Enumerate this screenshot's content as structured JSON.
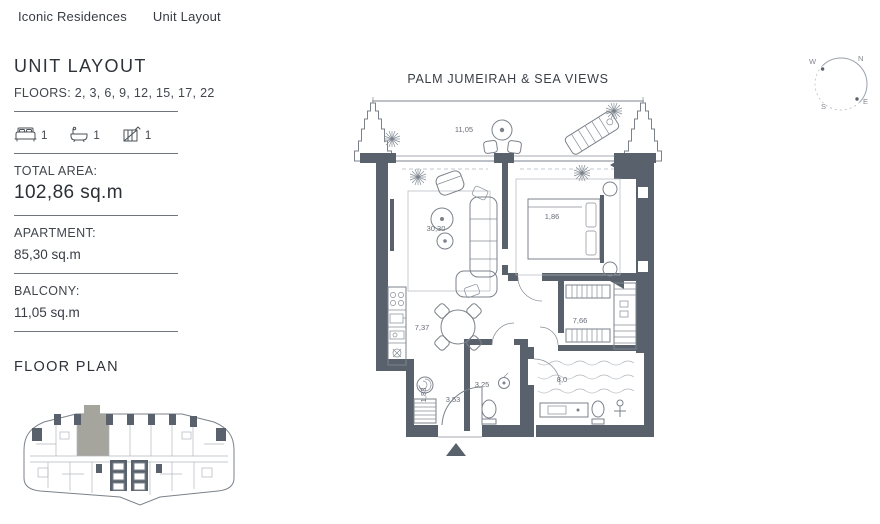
{
  "nav": {
    "brand": "Iconic Residences",
    "page": "Unit Layout"
  },
  "sidebar": {
    "title": "UNIT LAYOUT",
    "floors": "FLOORS: 2, 3, 6, 9, 12, 15, 17, 22",
    "features": [
      {
        "name": "bedrooms",
        "count": "1"
      },
      {
        "name": "bathrooms",
        "count": "1"
      },
      {
        "name": "balconies",
        "count": "1"
      }
    ],
    "stats": [
      {
        "label": "TOTAL AREA:",
        "value": "102,86 sq.m"
      },
      {
        "label": "APARTMENT:",
        "value": "85,30 sq.m"
      },
      {
        "label": "BALCONY:",
        "value": "11,05 sq.m"
      }
    ],
    "floor_plan_title": "FLOOR PLAN"
  },
  "plan": {
    "view_label": "PALM JUMEIRAH & SEA VIEWS",
    "labels": {
      "balcony": "11,05",
      "living": "30,30",
      "bedroom": "1,86",
      "kitchen": "7,37",
      "wardrobe": "7,66",
      "bathroom": "8,0",
      "wc": "3,25",
      "hall": "3,53",
      "laundry": "1,83"
    }
  },
  "compass": {
    "n": "N",
    "e": "E",
    "s": "S",
    "w": "W"
  },
  "colors": {
    "wall": "#59616d",
    "plan_line": "#7b828b",
    "unit_highlight": "#a5a59d"
  }
}
